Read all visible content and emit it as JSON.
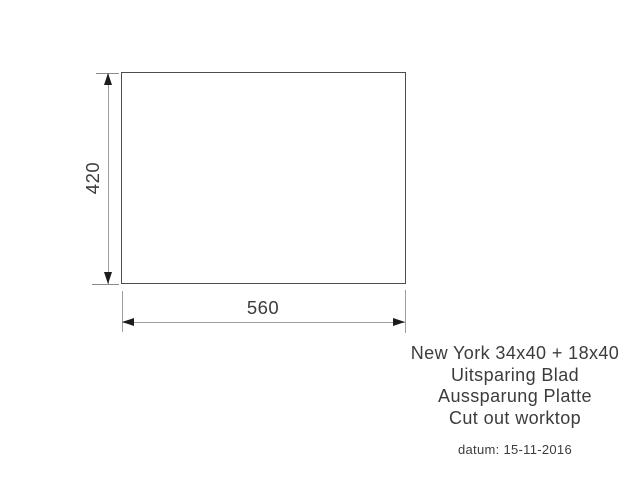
{
  "drawing": {
    "width_label": "560",
    "height_label": "420"
  },
  "caption": {
    "title": "New York 34x40 + 18x40",
    "line_nl": "Uitsparing Blad",
    "line_de": "Aussparung Platte",
    "line_en": "Cut out worktop",
    "date": "datum: 15-11-2016"
  },
  "colors": {
    "background": "#ffffff",
    "outline": "#4d4d4d",
    "dimension-line": "#9e9e9e",
    "tick": "#8a8a8a",
    "arrow": "#1c1c1c",
    "text": "#3c3c3c"
  }
}
